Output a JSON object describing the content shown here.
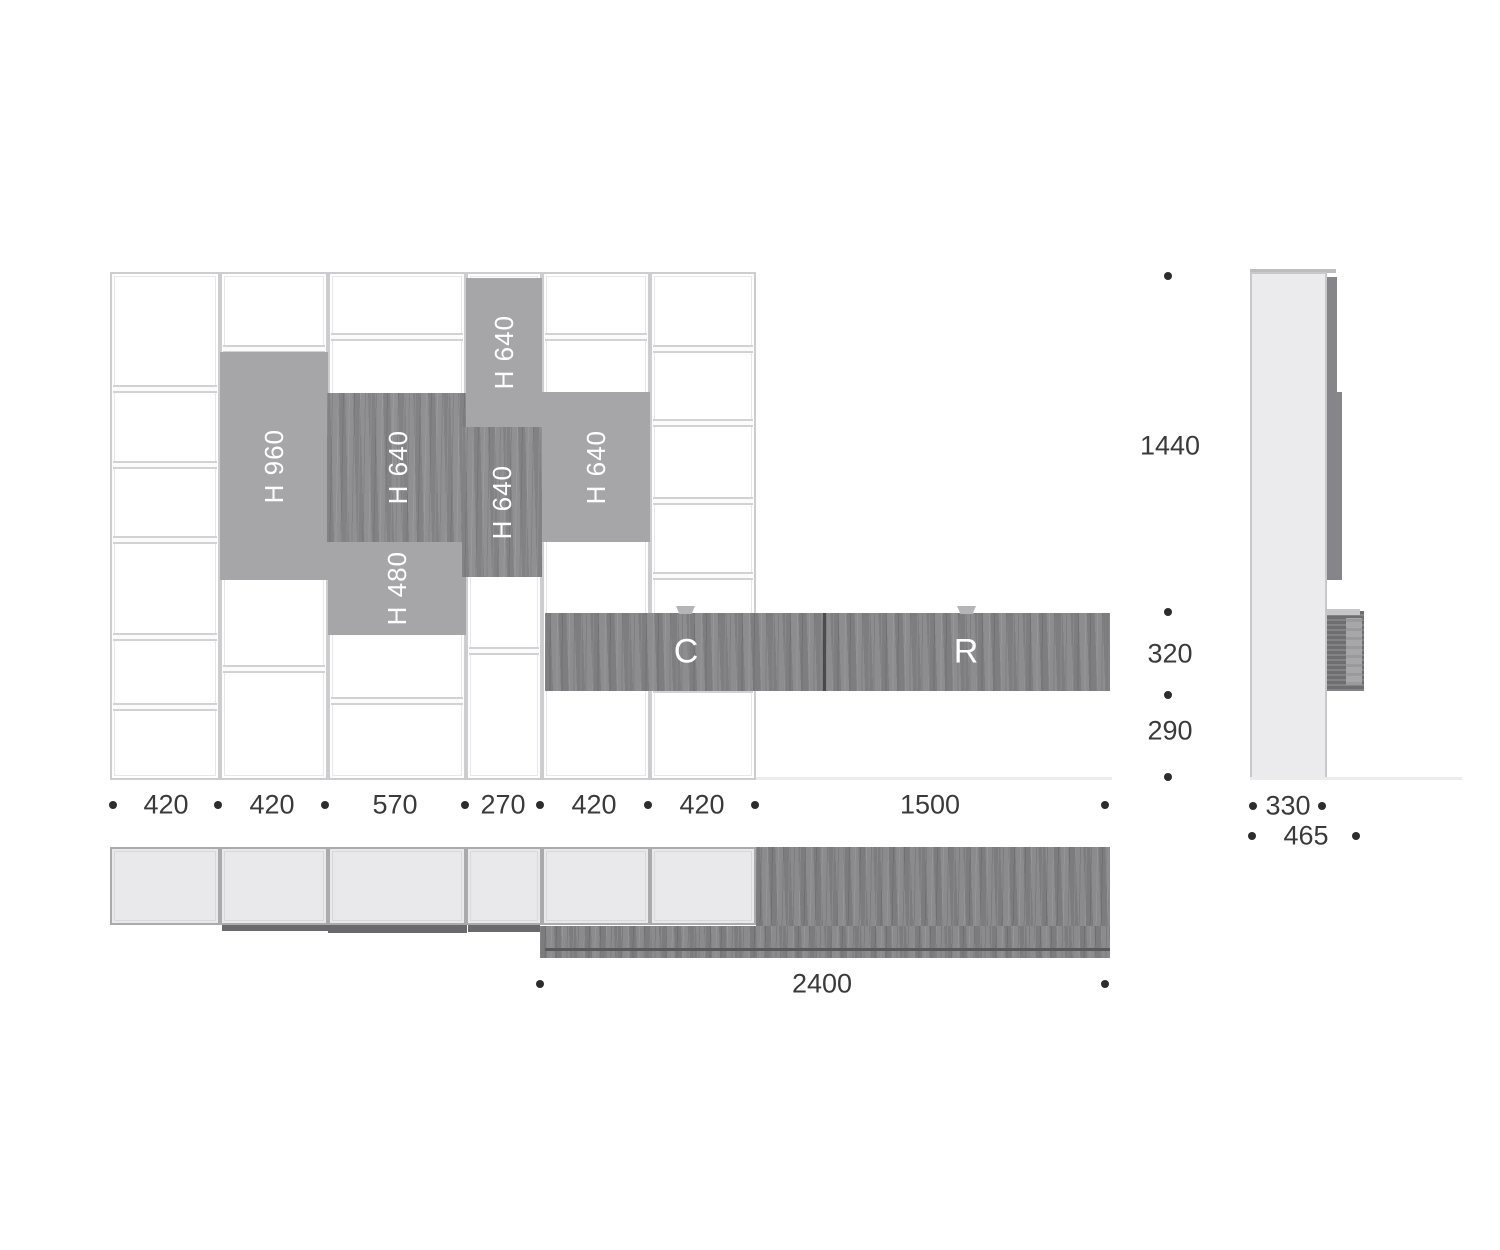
{
  "title": "Wall unit technical dimension drawing",
  "front_view": {
    "panels": [
      {
        "label": "H 960",
        "finish": "gray"
      },
      {
        "label": "H 640",
        "finish": "wood"
      },
      {
        "label": "H 480",
        "finish": "gray"
      },
      {
        "label": "H 640",
        "finish": "gray"
      },
      {
        "label": "H 640",
        "finish": "wood"
      },
      {
        "label": "H 640",
        "finish": "gray"
      }
    ],
    "cabinet": {
      "left": "C",
      "right": "R"
    }
  },
  "dims": {
    "bottom": [
      "420",
      "420",
      "570",
      "270",
      "420",
      "420",
      "1500"
    ],
    "right": [
      "1440",
      "320",
      "290"
    ],
    "side": [
      "330",
      "465"
    ],
    "plan": [
      "2400"
    ]
  },
  "colors": {
    "panel_gray": "#a6a6a8",
    "wood_gray": "#8a8a8c",
    "frame_line": "#cdcdcf",
    "dim_text": "#3a3a3c"
  }
}
